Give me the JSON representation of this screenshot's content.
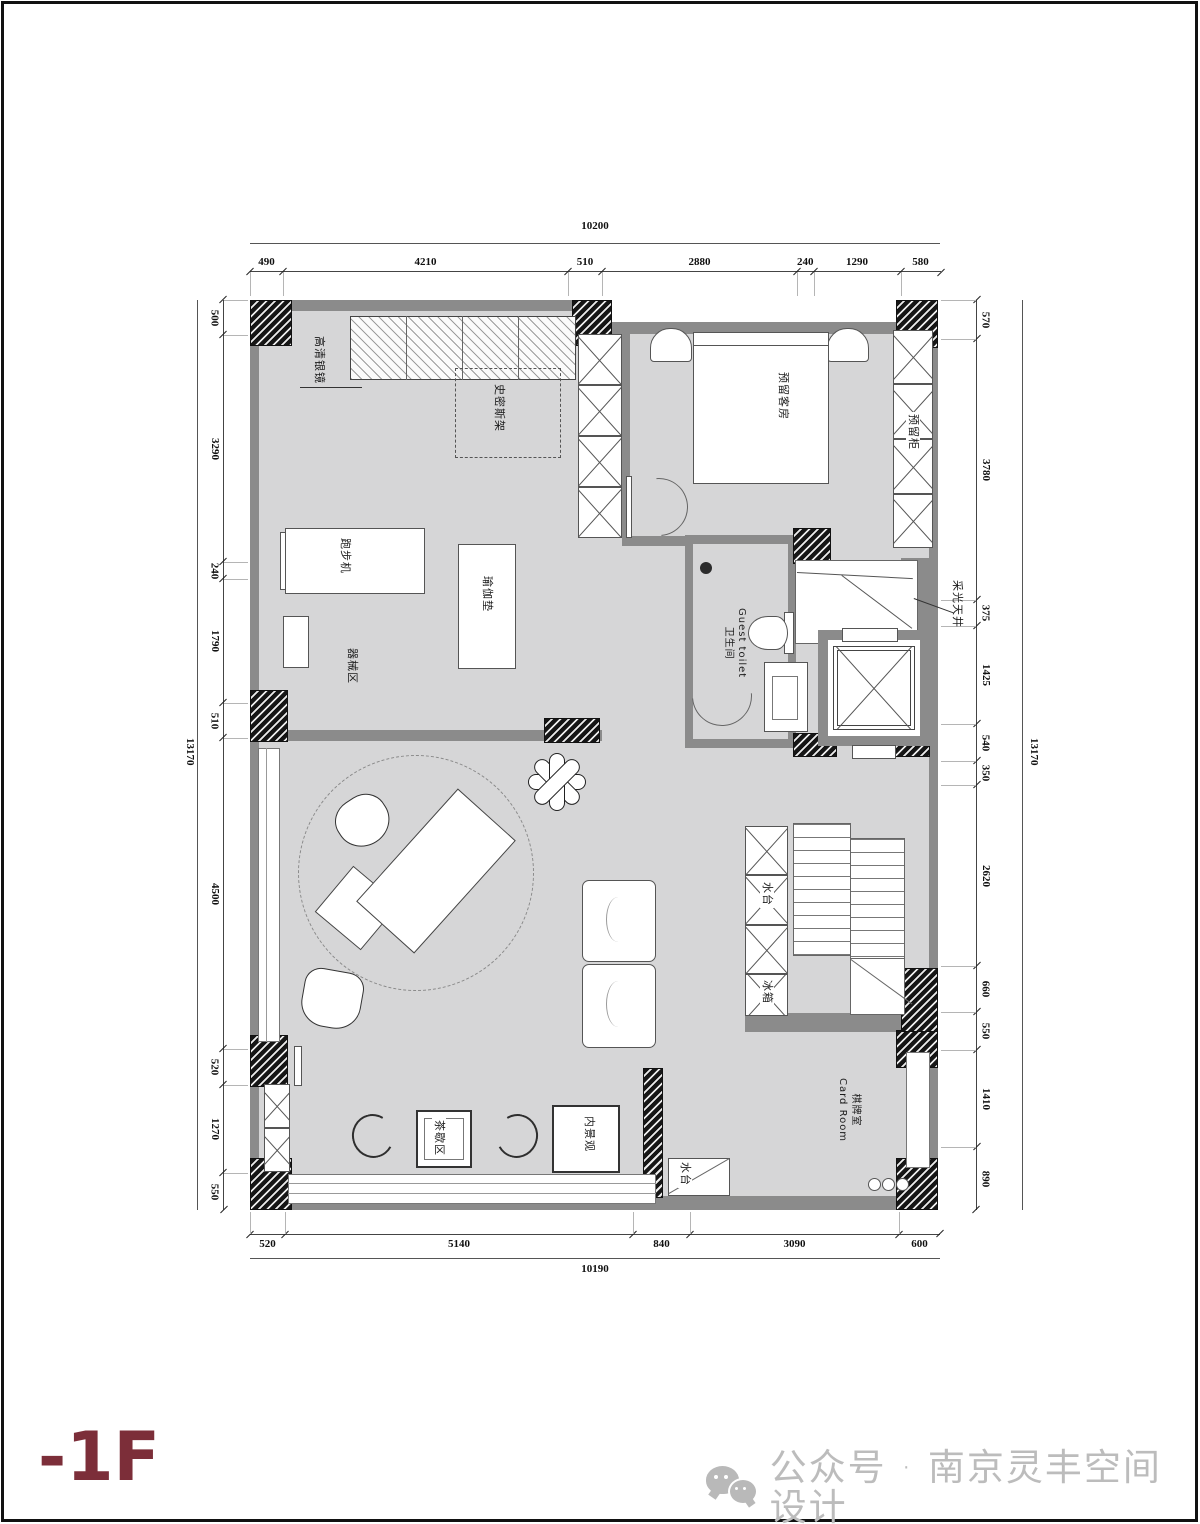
{
  "floor_label": "-1F",
  "watermark": {
    "icon": "wechat-icon",
    "text": "公众号 · 南京灵丰空间设计"
  },
  "dimensions": {
    "top": {
      "total": "10200",
      "segments": [
        "490",
        "4210",
        "510",
        "2880",
        "240",
        "1290",
        "580"
      ]
    },
    "bottom": {
      "total": "10190",
      "segments": [
        "520",
        "5140",
        "840",
        "3090",
        "600"
      ]
    },
    "left": {
      "total": "13170",
      "segments": [
        "500",
        "3290",
        "240",
        "1790",
        "510",
        "4500",
        "520",
        "1270",
        "550"
      ]
    },
    "right": {
      "total": "13170",
      "segments": [
        "570",
        "3780",
        "375",
        "1425",
        "540",
        "350",
        "2620",
        "660",
        "550",
        "1410",
        "890"
      ]
    }
  },
  "labels": {
    "mirror": "高清银镜",
    "smith_rack": "史密斯架",
    "treadmill": "跑步机",
    "yoga_mat": "瑜伽垫",
    "equipment_area": "器械区",
    "guest_room": "预留客房",
    "reserved_cabinet": "预留柜",
    "toilet_en": "Guest toilet",
    "toilet_cn": "卫生间",
    "skylight": "采光天井",
    "water_counter": "水台",
    "fridge": "冰箱",
    "card_room_cn": "棋牌室",
    "card_room_en": "Card Room",
    "tea_area": "茶歇区",
    "inner_landscape": "内景观",
    "water_counter_2": "水台"
  },
  "colors": {
    "floor": "#d6d6d7",
    "wall": "#8b8b8b",
    "pier": "#161616",
    "accent": "#7c2e39",
    "watermark": "#bcbcbc"
  }
}
